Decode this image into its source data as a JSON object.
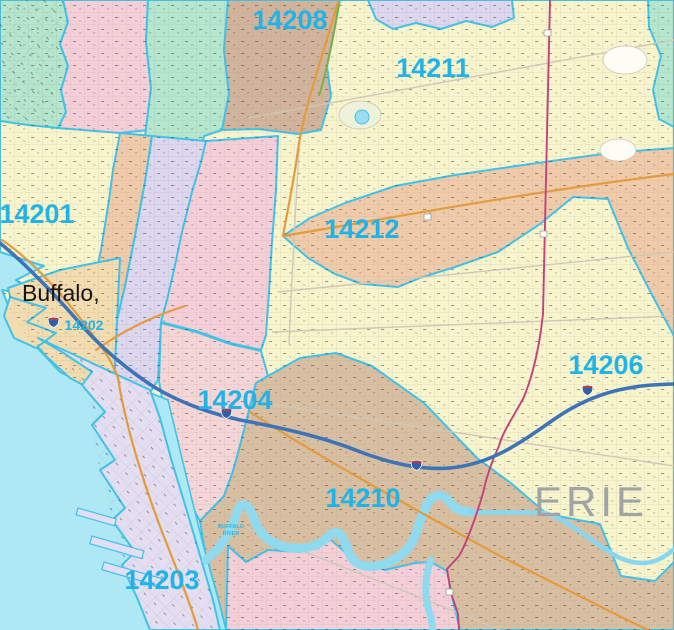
{
  "map": {
    "title": "Buffalo NY ZIP code map",
    "labels": {
      "z14201": "14201",
      "z14202": "14202",
      "z14203": "14203",
      "z14204": "14204",
      "z14206": "14206",
      "z14208": "14208",
      "z14210": "14210",
      "z14211": "14211",
      "z14212": "14212",
      "city": "Buffalo,",
      "county": "ERIE",
      "river_1": "BUFFALO",
      "river_2": "RIVER"
    },
    "colors": {
      "label_cyan": "#1eb4e9",
      "boundary_cyan": "#3fc3ea",
      "water": "#aee8f4",
      "zone_yellow": "#f8f5cd",
      "zone_mint": "#b5e7cf",
      "zone_pink": "#f5cfd8",
      "zone_brown": "#d2b49c",
      "zone_lavender": "#dcd6ee",
      "zone_wheat": "#f3ddb0",
      "zone_salmon": "#f0cbaa",
      "zone_pink_south": "#f6d5d6",
      "zone_tan": "#d9bfa2",
      "zone_peninsula": "#e3def1",
      "county_gray": "#a0a4a4",
      "river_blue": "#8fdaef",
      "interstate_blue": "#3d74b8",
      "route_magenta": "#c2427e",
      "road_orange": "#e39b3e",
      "parkway_green": "#76b14c"
    }
  }
}
